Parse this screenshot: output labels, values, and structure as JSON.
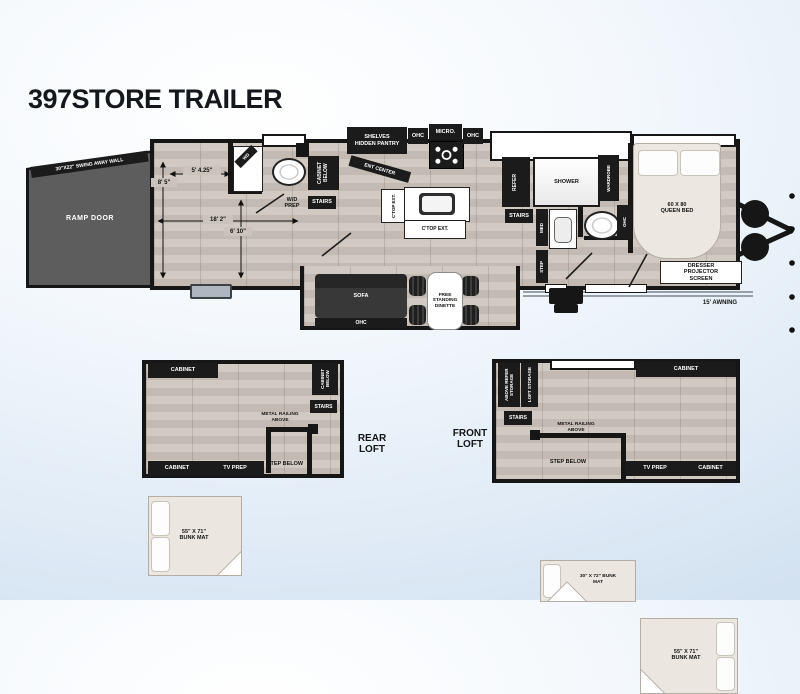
{
  "title": "397STORE TRAILER",
  "main": {
    "ramp_door": "RAMP DOOR",
    "swing_wall": "30\"X22\" SWING AWAY WALL",
    "dim_h1": "8' 5\"",
    "dim_w1": "5' 4.25\"",
    "dim_l": "18' 2\"",
    "dim_h2": "6' 10\"",
    "wd": "WD",
    "wd_prep": "W/D PREP",
    "cabinet_below": "CABINET BELOW",
    "stairs": "STAIRS",
    "shelves": "SHELVES",
    "hidden_pantry": "HIDDEN PANTRY",
    "ent_center": "ENT CENTER",
    "ohc": "OHC",
    "micro": "MICRO.",
    "ctop_ext": "C'TOP EXT.",
    "refer": "REFER",
    "shower": "SHOWER",
    "wardrobe": "WARDROBE",
    "med": "MED",
    "step": "STEP",
    "sofa": "SOFA",
    "dinette": "FREE STANDING DINETTE",
    "queen_bed": "60 X 80 QUEEN BED",
    "dresser": "DRESSER PROJECTOR SCREEN",
    "awning": "15' AWNING"
  },
  "rear": {
    "name": "REAR LOFT",
    "cabinet": "CABINET",
    "bunk": "55\" X 71\" BUNK MAT",
    "cabinet_below": "CABINET BELOW",
    "stairs": "STAIRS",
    "railing": "METAL RAILING ABOVE",
    "step_below": "STEP BELOW",
    "tv_prep": "TV PREP",
    "cabinet2": "CABINET"
  },
  "front": {
    "name": "FRONT LOFT",
    "above_refer": "ABOVE REFER STORAGE",
    "loft_storage": "LOFT STORAGE",
    "stairs": "STAIRS",
    "bunk30": "30\" X 72\" BUNK MAT",
    "cabinet": "CABINET",
    "bunk55": "55\" X 71\" BUNK MAT",
    "railing": "METAL RAILING ABOVE",
    "step_below": "STEP BELOW",
    "tv_prep": "TV PREP",
    "cabinet2": "CABINET"
  }
}
